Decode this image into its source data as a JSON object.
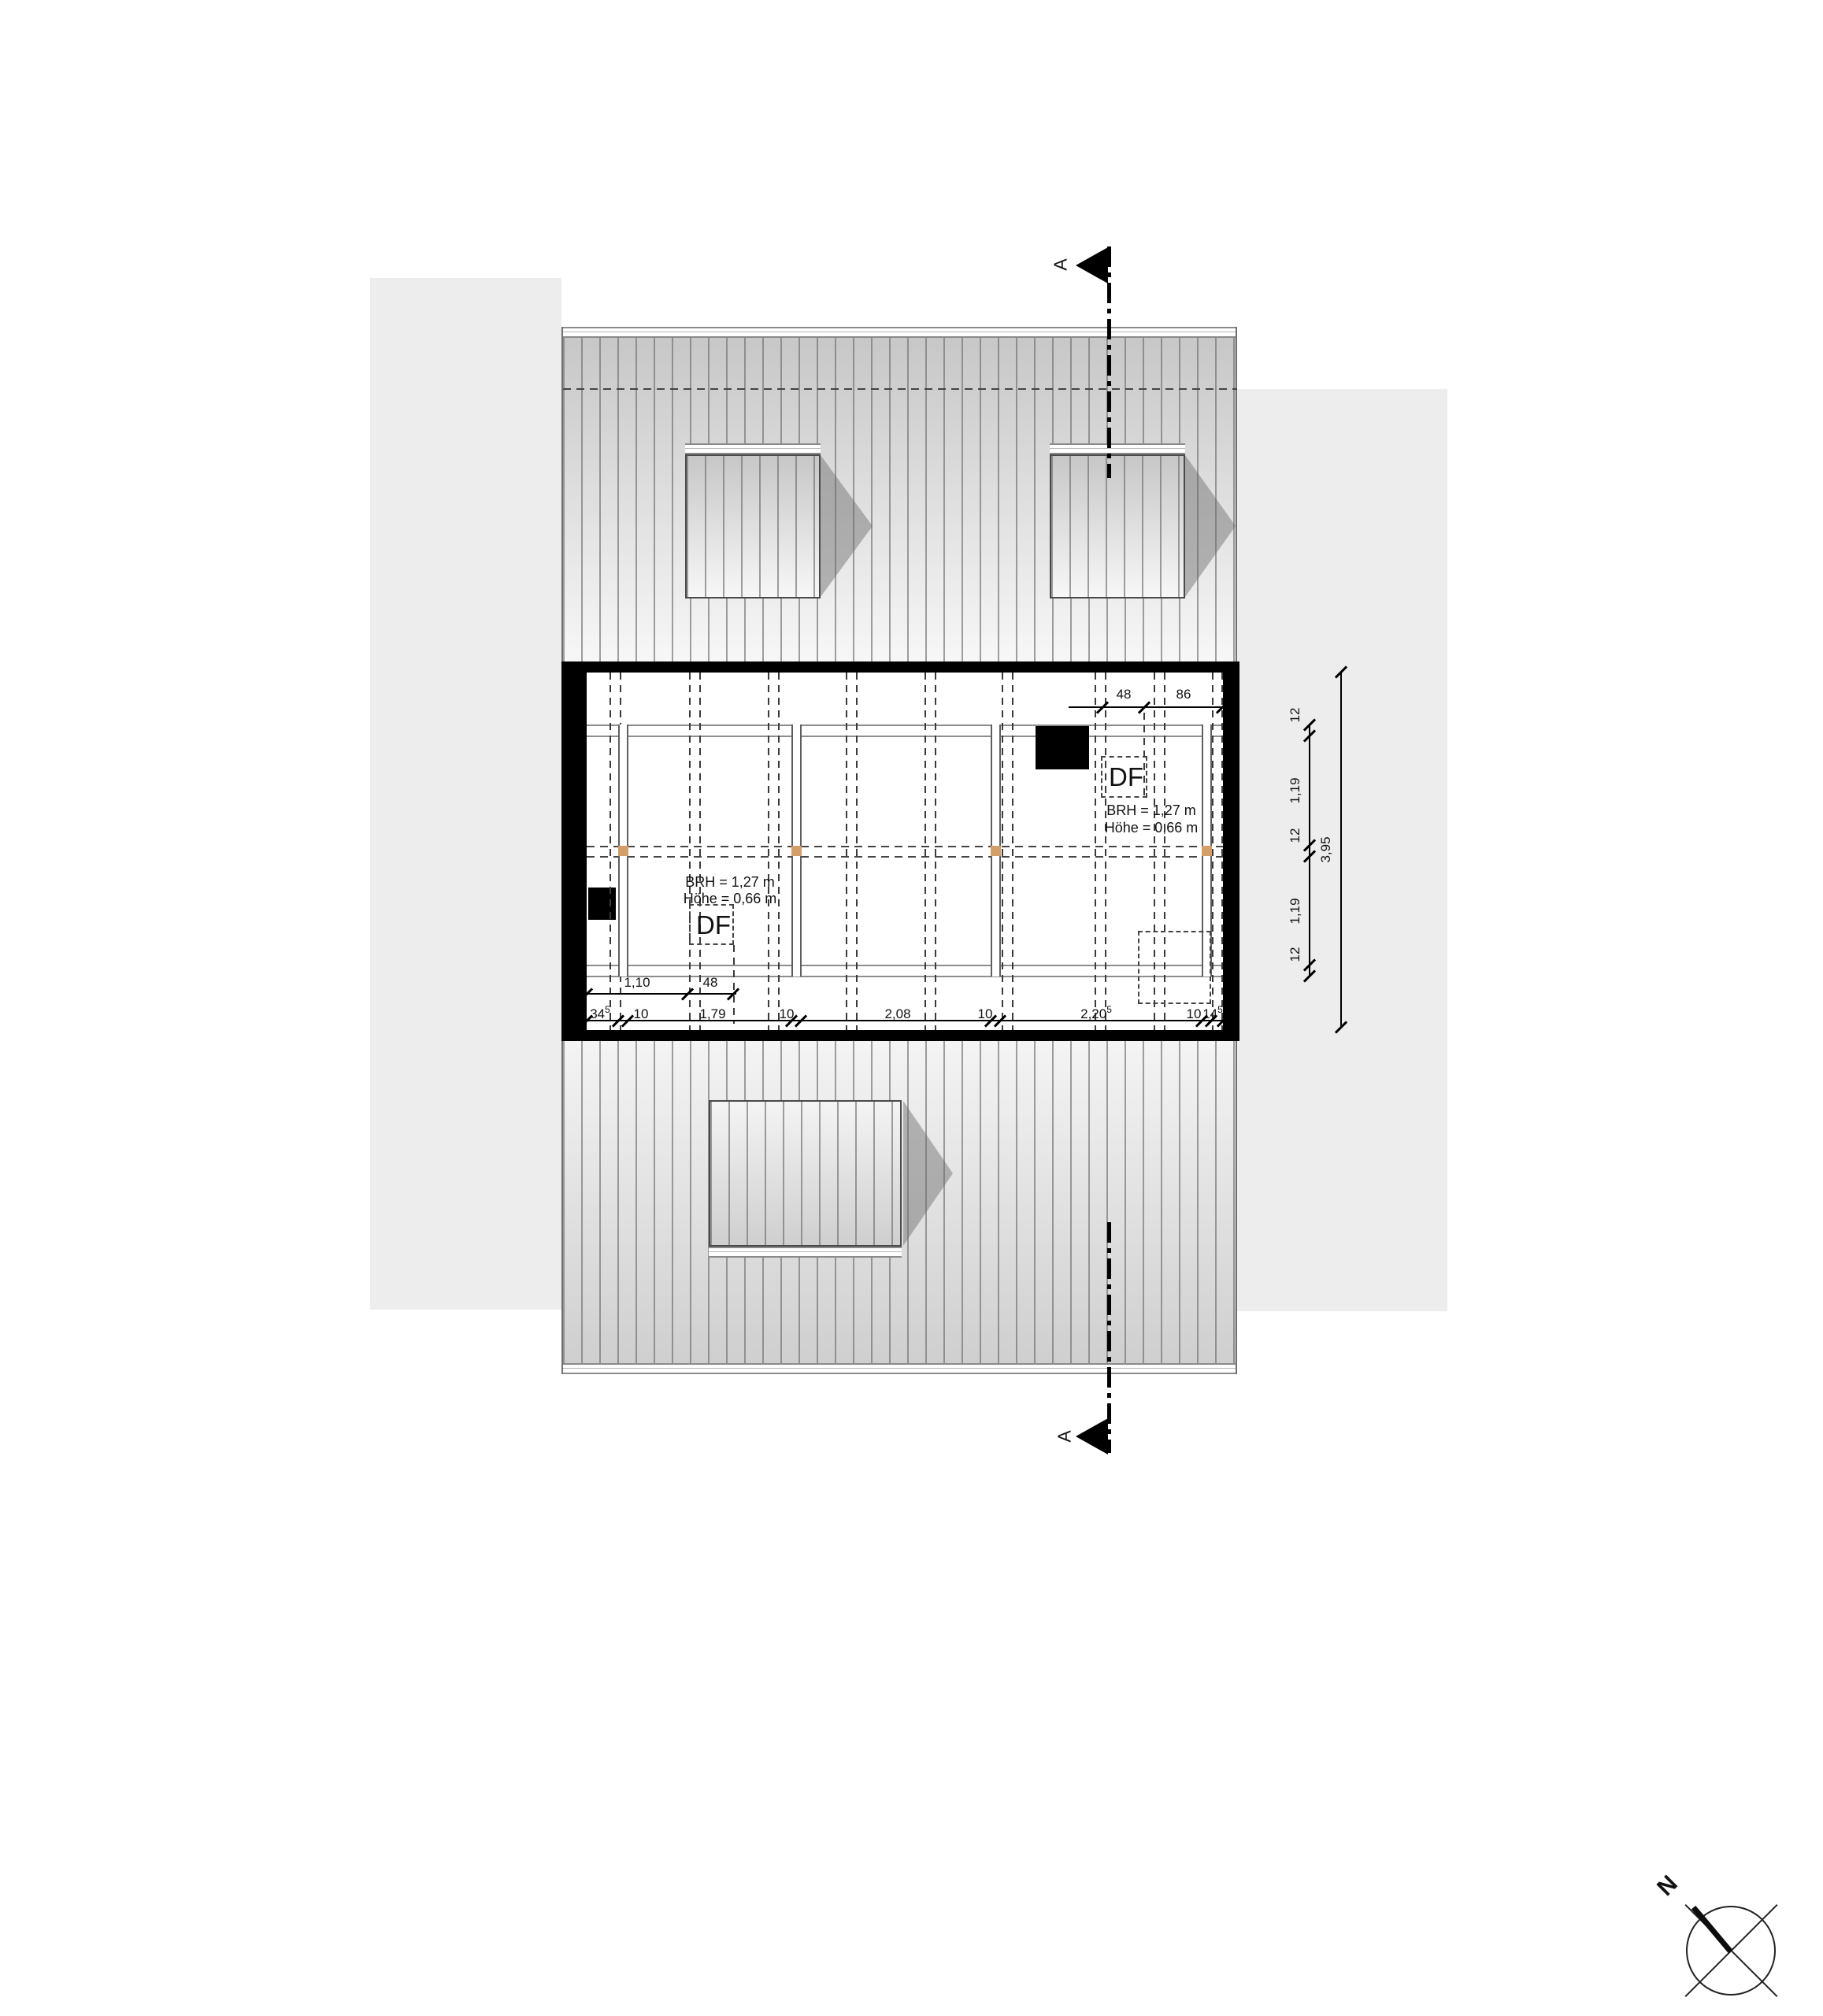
{
  "drawing": {
    "type_note": "roof storey floor plan",
    "section_mark": {
      "label": "A"
    },
    "compass": {
      "label": "N"
    },
    "windows": {
      "right": {
        "code": "DF",
        "line1": "BRH = 1,27 m",
        "line2": "Höhe = 0,66 m"
      },
      "left": {
        "code": "DF",
        "line1": "BRH = 1,27 m",
        "line2": "Höhe = 0,66 m"
      }
    },
    "dims": {
      "top_right": [
        "48",
        "86"
      ],
      "bottom_row1": [
        "1,10",
        "48"
      ],
      "bottom_row2": [
        {
          "text": "34",
          "sup": "5"
        },
        {
          "text": "10",
          "sup": ""
        },
        {
          "text": "1,79",
          "sup": ""
        },
        {
          "text": "10",
          "sup": ""
        },
        {
          "text": "2,08",
          "sup": ""
        },
        {
          "text": "10",
          "sup": ""
        },
        {
          "text": "2,20",
          "sup": "5"
        },
        {
          "text": "10",
          "sup": ""
        },
        {
          "text": "14",
          "sup": "5"
        }
      ],
      "right_chain": [
        "12",
        "1,19",
        "12",
        "1,19",
        "12"
      ],
      "right_total": "3,95"
    },
    "colors": {
      "wall": "#000000",
      "beam_marker": "#d49e6a",
      "background_panel": "#ededed",
      "roof_stripe": "#6e6e6e"
    }
  }
}
